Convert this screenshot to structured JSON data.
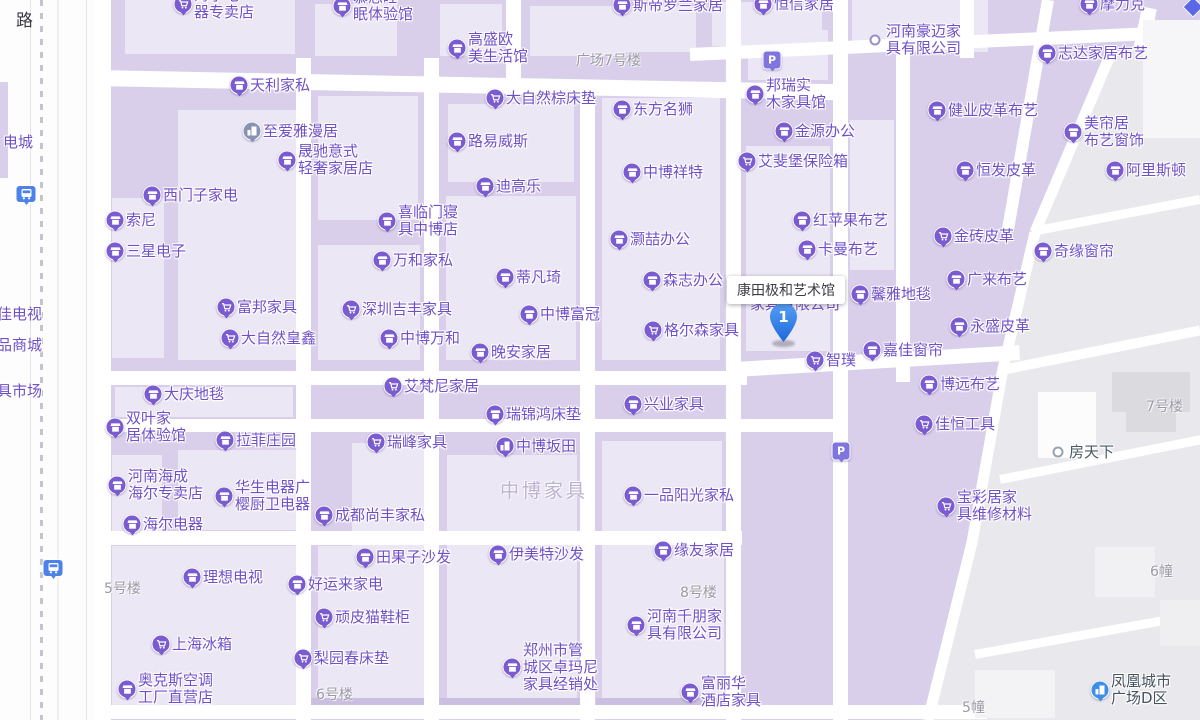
{
  "map": {
    "tooltip": {
      "text": "康田极和艺术馆"
    },
    "selected_marker": {
      "number": "1"
    },
    "hidden_label": {
      "text": "家具有限公司"
    },
    "road_label": {
      "text": "路"
    },
    "colors": {
      "poi_text": "#6F50C8",
      "pin": "#7A5BD0",
      "selected_marker": "#2F81F0",
      "parking": "#8074DE",
      "bus": "#4D82E8",
      "block": "#D9CFEB",
      "road": "#FFFFFF",
      "gray_district": "#E9E8EC"
    },
    "pois": [
      {
        "label": "海尔电器专卖店",
        "lines": [
          "海尔电",
          "器专卖店"
        ],
        "x": 183,
        "y": 4,
        "icon": "cart"
      },
      {
        "label": "慕思睡眠体验馆",
        "lines": [
          "慕思睡",
          "眠体验馆"
        ],
        "x": 342,
        "y": 6,
        "icon": "store"
      },
      {
        "label": "高盛欧美生活馆",
        "lines": [
          "高盛欧",
          "美生活馆"
        ],
        "x": 457,
        "y": 48,
        "icon": "store"
      },
      {
        "label": "斯帝罗兰家居",
        "x": 622,
        "y": 5,
        "icon": "store"
      },
      {
        "label": "恒信家居",
        "x": 763,
        "y": 4,
        "icon": "store"
      },
      {
        "label": "摩力克",
        "x": 1089,
        "y": 4,
        "icon": "store"
      },
      {
        "label": "河南豪迈家具有限公司",
        "lines": [
          "河南豪迈家",
          "具有限公司"
        ],
        "x": 875,
        "y": 40,
        "icon": "dot"
      },
      {
        "label": "志达家居布艺",
        "x": 1047,
        "y": 53,
        "icon": "store"
      },
      {
        "label": "天利家私",
        "x": 239,
        "y": 85,
        "icon": "store"
      },
      {
        "label": "",
        "x": 772,
        "y": 60,
        "icon": "p"
      },
      {
        "label": "大自然棕床垫",
        "x": 495,
        "y": 98,
        "icon": "cart"
      },
      {
        "label": "东方名狮",
        "x": 622,
        "y": 109,
        "icon": "store"
      },
      {
        "label": "邦瑞实木家具馆",
        "lines": [
          "邦瑞实",
          "木家具馆"
        ],
        "x": 755,
        "y": 94,
        "icon": "store"
      },
      {
        "label": "至爱雅漫居",
        "x": 252,
        "y": 131,
        "icon": "apt",
        "pin": "#8793B0"
      },
      {
        "label": "金源办公",
        "x": 784,
        "y": 131,
        "icon": "store"
      },
      {
        "label": "健业皮革布艺",
        "x": 937,
        "y": 110,
        "icon": "store"
      },
      {
        "label": "美帘居布艺窗饰",
        "lines": [
          "美帘居",
          "布艺窗饰"
        ],
        "x": 1073,
        "y": 132,
        "icon": "store"
      },
      {
        "label": "路易威斯",
        "x": 457,
        "y": 141,
        "icon": "store"
      },
      {
        "label": "晟驰意式轻奢家居店",
        "lines": [
          "晟驰意式",
          "轻奢家居店"
        ],
        "x": 287,
        "y": 160,
        "icon": "store"
      },
      {
        "label": "西门子家电",
        "x": 152,
        "y": 195,
        "icon": "store"
      },
      {
        "label": "艾斐堡保险箱",
        "x": 747,
        "y": 161,
        "icon": "cart"
      },
      {
        "label": "恒发皮革",
        "x": 965,
        "y": 170,
        "icon": "store"
      },
      {
        "label": "中博祥特",
        "x": 632,
        "y": 172,
        "icon": "store"
      },
      {
        "label": "阿里斯顿",
        "x": 1115,
        "y": 170,
        "icon": "store"
      },
      {
        "label": "索尼",
        "x": 115,
        "y": 220,
        "icon": "store"
      },
      {
        "label": "迪高乐",
        "x": 485,
        "y": 186,
        "icon": "store"
      },
      {
        "label": "喜临门寝具中博店",
        "lines": [
          "喜临门寝",
          "具中博店"
        ],
        "x": 387,
        "y": 221,
        "icon": "store"
      },
      {
        "label": "三星电子",
        "x": 115,
        "y": 251,
        "icon": "store"
      },
      {
        "label": "奇缘窗帘",
        "x": 1043,
        "y": 251,
        "icon": "store"
      },
      {
        "label": "灏喆办公",
        "x": 619,
        "y": 239,
        "icon": "store"
      },
      {
        "label": "红苹果布艺",
        "x": 802,
        "y": 220,
        "icon": "store"
      },
      {
        "label": "卡曼布艺",
        "x": 807,
        "y": 249,
        "icon": "store"
      },
      {
        "label": "金砖皮革",
        "x": 943,
        "y": 236,
        "icon": "cart"
      },
      {
        "label": "万和家私",
        "x": 382,
        "y": 260,
        "icon": "store"
      },
      {
        "label": "蒂凡琦",
        "x": 505,
        "y": 277,
        "icon": "store"
      },
      {
        "label": "广来布艺",
        "x": 956,
        "y": 279,
        "icon": "store"
      },
      {
        "label": "森志办公",
        "x": 652,
        "y": 280,
        "icon": "store"
      },
      {
        "label": "富邦家具",
        "x": 226,
        "y": 307,
        "icon": "cart"
      },
      {
        "label": "深圳吉丰家具",
        "x": 351,
        "y": 309,
        "icon": "cart"
      },
      {
        "label": "中博富冠",
        "x": 529,
        "y": 314,
        "icon": "store"
      },
      {
        "label": "馨雅地毯",
        "x": 860,
        "y": 294,
        "icon": "store"
      },
      {
        "label": "大自然皇鑫",
        "x": 230,
        "y": 338,
        "icon": "cart"
      },
      {
        "label": "中博万和",
        "x": 389,
        "y": 338,
        "icon": "store"
      },
      {
        "label": "格尔森家具",
        "x": 653,
        "y": 330,
        "icon": "cart"
      },
      {
        "label": "嘉佳窗帘",
        "x": 872,
        "y": 350,
        "icon": "store"
      },
      {
        "label": "永盛皮革",
        "x": 959,
        "y": 326,
        "icon": "store"
      },
      {
        "label": "晚安家居",
        "x": 480,
        "y": 352,
        "icon": "store"
      },
      {
        "label": "智璞",
        "x": 815,
        "y": 360,
        "icon": "cart"
      },
      {
        "label": "博远布艺",
        "x": 929,
        "y": 384,
        "icon": "store"
      },
      {
        "label": "大庆地毯",
        "x": 153,
        "y": 394,
        "icon": "store"
      },
      {
        "label": "艾梵尼家居",
        "x": 393,
        "y": 386,
        "icon": "cart"
      },
      {
        "label": "兴业家具",
        "x": 633,
        "y": 404,
        "icon": "store"
      },
      {
        "label": "瑞锦鸿床垫",
        "x": 495,
        "y": 414,
        "icon": "store"
      },
      {
        "label": "双叶家居体验馆",
        "lines": [
          "双叶家",
          "居体验馆"
        ],
        "x": 115,
        "y": 427,
        "icon": "store"
      },
      {
        "label": "拉菲庄园",
        "x": 225,
        "y": 440,
        "icon": "store"
      },
      {
        "label": "佳恒工具",
        "x": 924,
        "y": 424,
        "icon": "cart"
      },
      {
        "label": "瑞峰家具",
        "x": 376,
        "y": 442,
        "icon": "cart"
      },
      {
        "label": "中博坂田",
        "x": 505,
        "y": 446,
        "icon": "apt"
      },
      {
        "label": "房天下",
        "x": 1058,
        "y": 452,
        "icon": "dot",
        "text_color": "#4A5866",
        "ring": "#97A2AD"
      },
      {
        "label": "河南海成海尔专卖店",
        "lines": [
          "河南海成",
          "海尔专卖店"
        ],
        "x": 117,
        "y": 485,
        "icon": "store"
      },
      {
        "label": "华生电器广樱厨卫电器",
        "lines": [
          "华生电器广",
          "樱厨卫电器"
        ],
        "x": 224,
        "y": 496,
        "icon": "store"
      },
      {
        "label": "一品阳光家私",
        "x": 633,
        "y": 495,
        "icon": "store"
      },
      {
        "label": "成都尚丰家私",
        "x": 324,
        "y": 515,
        "icon": "store"
      },
      {
        "label": "海尔电器",
        "x": 132,
        "y": 524,
        "icon": "store"
      },
      {
        "label": "宝彩居家具维修材料",
        "lines": [
          "宝彩居家",
          "具维修材料"
        ],
        "x": 946,
        "y": 506,
        "icon": "cart"
      },
      {
        "label": "",
        "x": 841,
        "y": 451,
        "icon": "p"
      },
      {
        "label": "田果子沙发",
        "x": 365,
        "y": 557,
        "icon": "store"
      },
      {
        "label": "伊美特沙发",
        "x": 498,
        "y": 554,
        "icon": "store"
      },
      {
        "label": "缘友家居",
        "x": 663,
        "y": 550,
        "icon": "store"
      },
      {
        "label": "理想电视",
        "x": 192,
        "y": 577,
        "icon": "store"
      },
      {
        "label": "好运来家电",
        "x": 297,
        "y": 584,
        "icon": "store"
      },
      {
        "label": "顽皮猫鞋柜",
        "x": 324,
        "y": 617,
        "icon": "cart"
      },
      {
        "label": "河南千朋家具有限公司",
        "lines": [
          "河南千朋家",
          "具有限公司"
        ],
        "x": 636,
        "y": 625,
        "icon": "store"
      },
      {
        "label": "上海冰箱",
        "x": 161,
        "y": 644,
        "icon": "cart"
      },
      {
        "label": "梨园春床垫",
        "x": 303,
        "y": 658,
        "icon": "cart"
      },
      {
        "label": "郑州市管城区卓玛尼家具经销处",
        "lines": [
          "郑州市管",
          "城区卓玛尼",
          "家具经销处"
        ],
        "x": 512,
        "y": 667,
        "icon": "store"
      },
      {
        "label": "奥克斯空调工厂直营店",
        "lines": [
          "奥克斯空调",
          "工厂直营店"
        ],
        "x": 127,
        "y": 689,
        "icon": "store"
      },
      {
        "label": "富丽华酒店家具",
        "lines": [
          "富丽华",
          "酒店家具"
        ],
        "x": 690,
        "y": 692,
        "icon": "store"
      },
      {
        "label": "凤凰城市广场D区",
        "lines": [
          "凤凰城市",
          "广场D区"
        ],
        "x": 1100,
        "y": 690,
        "icon": "build",
        "pin": "#3D8EE8",
        "text_color": "#44525E"
      },
      {
        "label": "",
        "x": 26,
        "y": 194,
        "icon": "bus"
      },
      {
        "label": "",
        "x": 53,
        "y": 568,
        "icon": "bus"
      },
      {
        "label": "",
        "x": 1193,
        "y": 7,
        "icon": "diamond"
      }
    ],
    "area_labels": [
      {
        "text": "广场7号楼",
        "x": 576,
        "y": 50
      },
      {
        "text": "7号楼",
        "x": 1146,
        "y": 396
      },
      {
        "text": "5号楼",
        "x": 104,
        "y": 578
      },
      {
        "text": "8号楼",
        "x": 680,
        "y": 582
      },
      {
        "text": "6号楼",
        "x": 316,
        "y": 684
      },
      {
        "text": "6幢",
        "x": 1150,
        "y": 561
      },
      {
        "text": "5幢",
        "x": 962,
        "y": 697
      },
      {
        "text": "中博家具",
        "x": 500,
        "y": 476,
        "big": true
      }
    ],
    "edge_labels": [
      {
        "text": "电城",
        "x": 3,
        "y": 134
      },
      {
        "text": "佳电视",
        "x": -3,
        "y": 306
      },
      {
        "text": "品商城",
        "x": -3,
        "y": 337
      },
      {
        "text": "具市场",
        "x": -3,
        "y": 383
      }
    ]
  }
}
